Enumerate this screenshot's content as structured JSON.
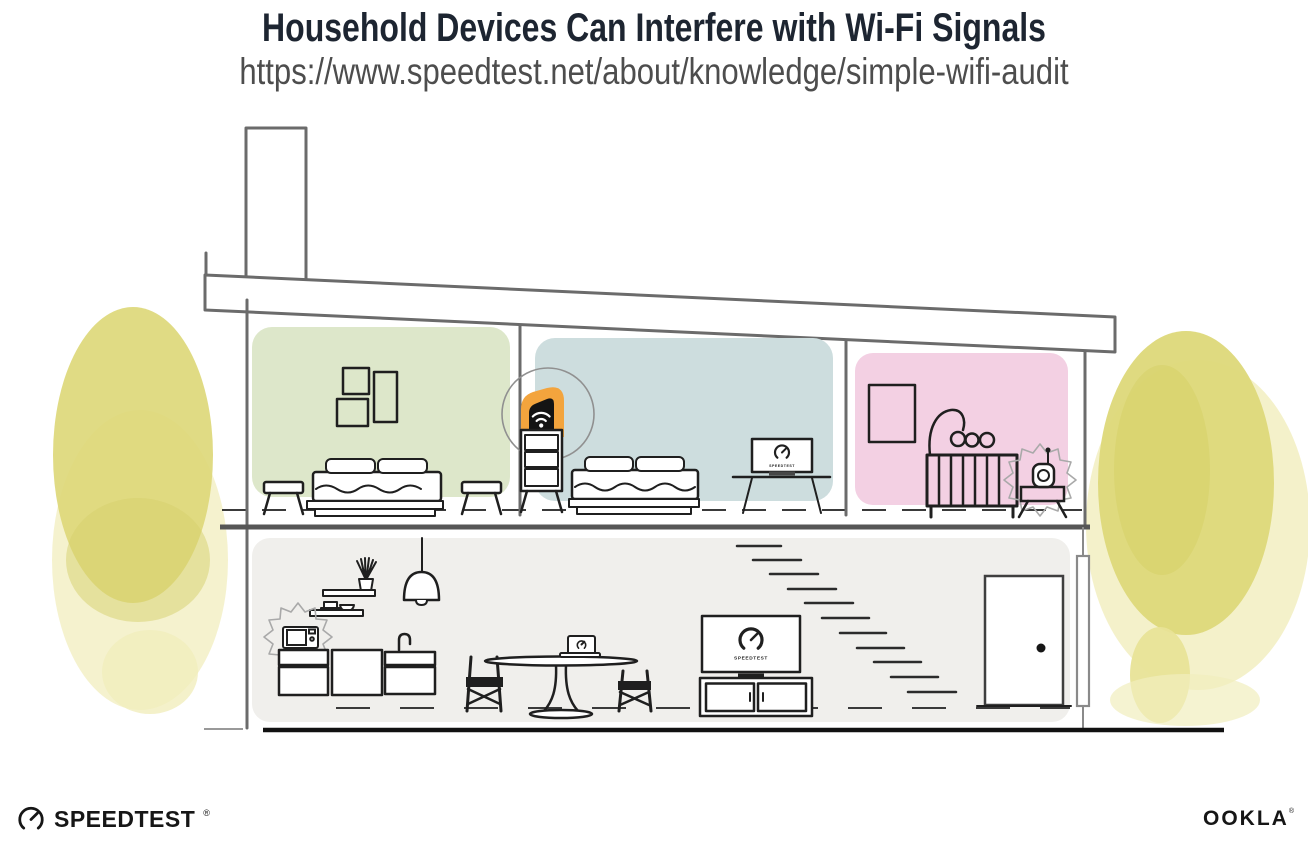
{
  "header": {
    "title": "Household Devices Can Interfere with Wi-Fi Signals",
    "url": "https://www.speedtest.net/about/knowledge/simple-wifi-audit"
  },
  "screens": {
    "bedroom_laptop_label": "SPEEDTEST",
    "living_room_tv_label": "SPEEDTEST"
  },
  "footer": {
    "speedtest_wordmark": "SPEEDTEST",
    "speedtest_reg": "®",
    "ookla_wordmark": "OOKLA",
    "ookla_reg": "®"
  },
  "icons": {
    "speedtest_gauge": "speedtest-gauge-icon",
    "wifi_router": "wifi-signal-icon",
    "microwave_interference": "interference-burst-icon",
    "baby_monitor_interference": "interference-burst-icon"
  },
  "colors": {
    "title-ink": "#1d2531",
    "url-ink": "#4d4d4d",
    "ink-black": "#161616",
    "line-dark": "#1f1f1f",
    "line-gray": "#6b6b6b",
    "wall-green": "#dde7ca",
    "wall-blue": "#cdddde",
    "wall-pink": "#f3d0e3",
    "floor-gray": "#f0efec",
    "accent-orange": "#f3a43d",
    "foliage-yellow": "#ddd879",
    "foliage-light": "#f1eebd",
    "router-black": "#141414"
  }
}
